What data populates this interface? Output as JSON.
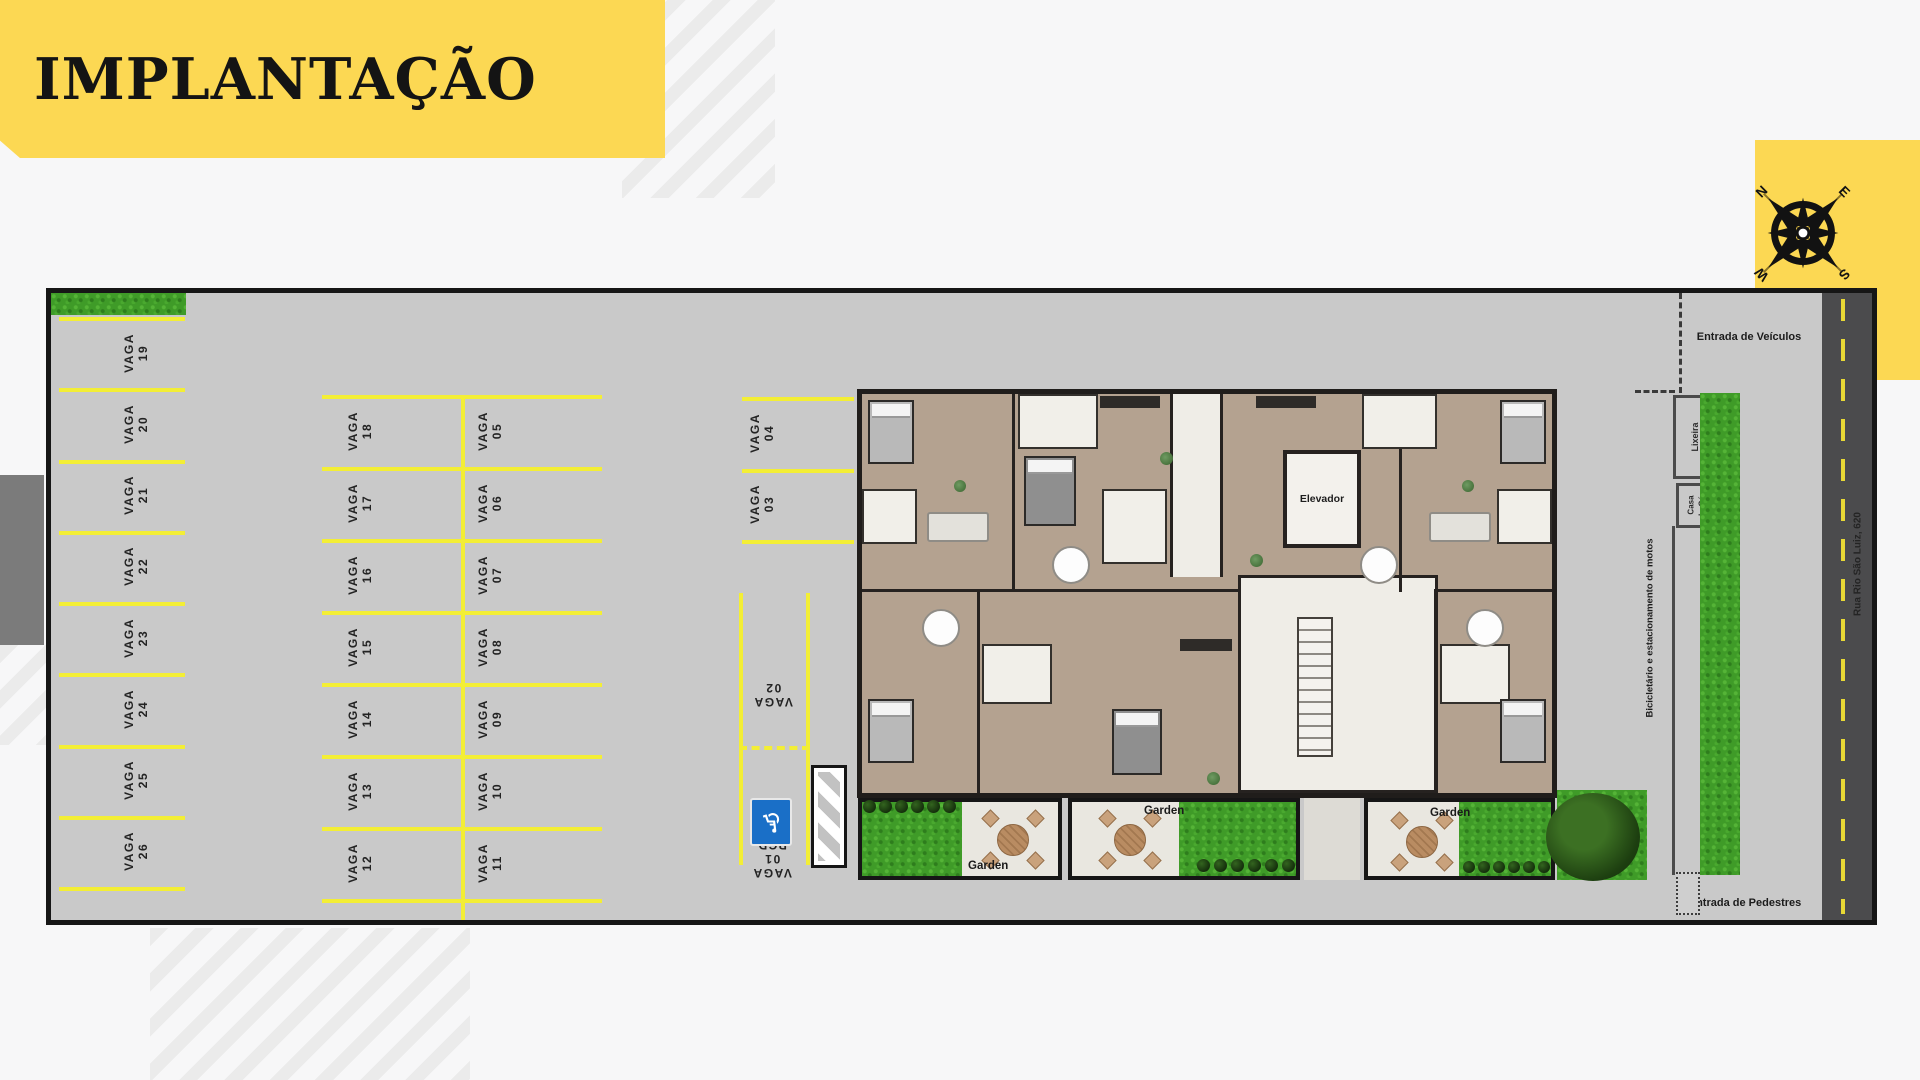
{
  "title": "IMPLANTAÇÃO",
  "compass": {
    "n": "N",
    "e": "E",
    "s": "S",
    "w": "W"
  },
  "parking": {
    "label_word": "VAGA",
    "col_left": [
      "19",
      "20",
      "21",
      "22",
      "23",
      "24",
      "25",
      "26"
    ],
    "col_mid_left": [
      "18",
      "17",
      "16",
      "15",
      "14",
      "13",
      "12"
    ],
    "col_mid_right": [
      "05",
      "06",
      "07",
      "08",
      "09",
      "10",
      "11"
    ],
    "col_single": [
      "04",
      "03"
    ],
    "vaga_02": "02",
    "pcd_lines": [
      "VAGA",
      "01",
      "PCD"
    ],
    "pcd_sign_icon": "wheelchair-icon"
  },
  "building": {
    "elevator_label": "Elevador",
    "garden_labels": [
      "Garden",
      "Garden",
      "Garden"
    ]
  },
  "site": {
    "vehicle_entrance": "Entrada de Veículos",
    "pedestrian_entrance": "Entrada de Pedestres",
    "trash": "Lixeira",
    "gas_line1": "Casa",
    "gas_line2": "do Gás",
    "bike_moto": "Bicicletário e estacionamento de motos",
    "street": "Rua Rio São Luiz, 620"
  },
  "colors": {
    "accent_yellow": "#fcd853",
    "parking_line_yellow": "#f3ee35",
    "plan_gray": "#c9c9c9",
    "road_gray": "#4b4b4d",
    "grass_green": "#3f9b28",
    "pcd_blue": "#1a6fc7"
  }
}
